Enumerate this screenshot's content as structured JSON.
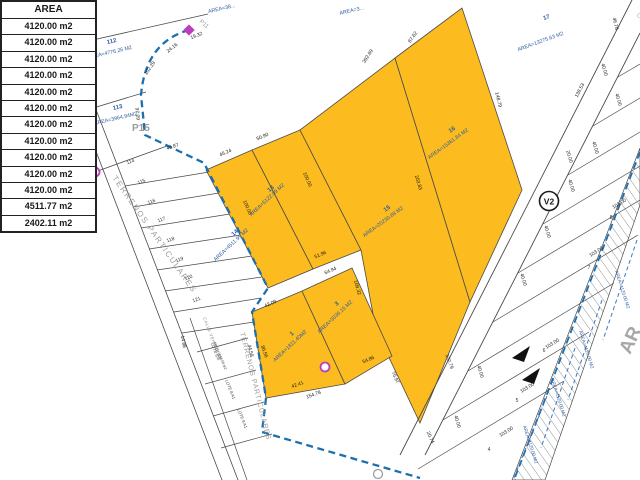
{
  "table": {
    "header": "AREA",
    "rows": [
      "4120.00 m2",
      "4120.00 m2",
      "4120.00 m2",
      "4120.00 m2",
      "4120.00 m2",
      "4120.00 m2",
      "4120.00 m2",
      "4120.00 m2",
      "4120.00 m2",
      "4120.00 m2",
      "4120.00 m2",
      "4511.77 m2",
      "2402.11 m2"
    ]
  },
  "map": {
    "streets": {
      "calle_vehicular": "CALLE VEHICULAR",
      "calle_vehicular_small": "CALLE VEHICULAR",
      "terrenos_1": "TERRENOS PARTICULARES",
      "terrenos_2": "TERRENOS PARTICULARES",
      "road_v2": "V2",
      "road_ar_partial": "AR",
      "calle_clipped": "CALLE",
      "p15": "P15",
      "p11": "P11"
    },
    "parcels": [
      {
        "num": "112",
        "area": "AREA=4776.26 M2"
      },
      {
        "num": "113",
        "area": "AREA=3964.94M2"
      },
      {
        "num": "13",
        "area": "AREA=5122.09 M2"
      },
      {
        "num": "14",
        "area": "AREA=4511.99 M2"
      },
      {
        "num": "15",
        "area": "AREA=20230.88 M2"
      },
      {
        "num": "16",
        "area": "AREA=15361.84 M2"
      },
      {
        "num": "17",
        "area": "AREA=13275.63 M2"
      },
      {
        "num": "1",
        "area": "AREA=1811.40M2"
      },
      {
        "num": "3",
        "area": "AREA=3036.15 M2"
      }
    ],
    "clipped_area_labels": [
      "AREA=4...",
      "AREA=38...",
      "AREA=3..."
    ],
    "strip_parcel_numbers": [
      "114",
      "115",
      "116",
      "117",
      "118",
      "119",
      "120",
      "121"
    ],
    "right_parcel_numbers": [
      "8",
      "7",
      "6",
      "5",
      "4"
    ],
    "lot_labels": {
      "lote_a": "LOTE 8'A",
      "lote_a_area": "AREA=1068.08 M2",
      "lote_b": "LOTE 8 A1",
      "lote_c": "LOTE 8 A1"
    },
    "right_area_labels": [
      "AREA=4120.00 M2",
      "AREA=4120.00 M2",
      "AREA=4120.00 M2",
      "AREA=4120.00 M2"
    ],
    "measurements": [
      "392.69",
      "87.62",
      "148.79",
      "203.83",
      "102.79",
      "76.97",
      "20.74",
      "45.24",
      "50.90",
      "100.00",
      "100.00",
      "51.96",
      "42.09",
      "64.94",
      "86.56",
      "109.32",
      "54.86",
      "42.41",
      "154.78",
      "102.29",
      "24.16",
      "19.32",
      "97.09",
      "45.87",
      "44.58",
      "14.88",
      "138.53",
      "46.78",
      "20.00",
      "40.00",
      "40.00",
      "40.00",
      "40.00",
      "40.00",
      "40.00",
      "40.00",
      "40.00",
      "103.00",
      "103.00",
      "103.00",
      "103.00",
      "103.00"
    ],
    "colors": {
      "parcel_yellow": "#FCBB1E",
      "boundary_blue": "#1E6FAE",
      "label_blue": "#2F5B9E",
      "node_magenta": "#BB3FBB"
    }
  }
}
